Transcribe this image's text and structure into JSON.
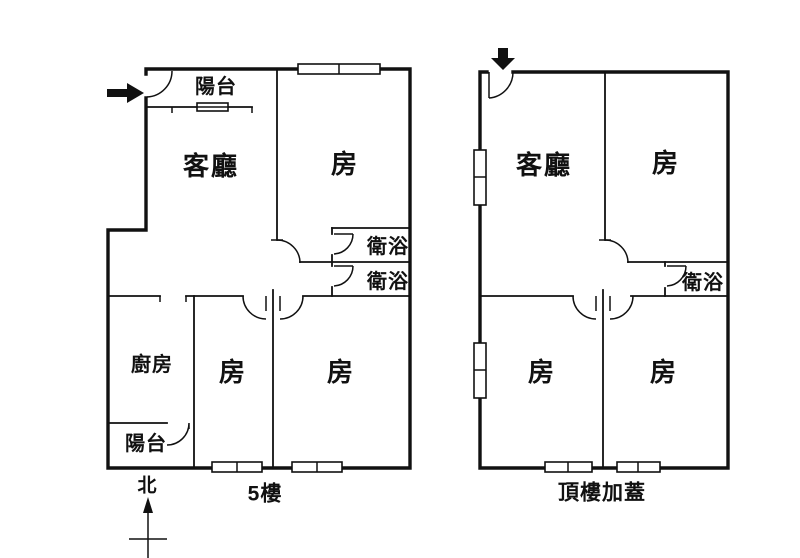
{
  "colors": {
    "background": "#ffffff",
    "line": "#111111",
    "text": "#111111"
  },
  "plans": [
    {
      "name": "floor-5",
      "caption": "5樓",
      "entry_icon": "arrow-right-icon",
      "compass": {
        "label": "北",
        "icon": "north-arrow-icon"
      },
      "rooms": [
        {
          "label": "陽台"
        },
        {
          "label": "客廳"
        },
        {
          "label": "房"
        },
        {
          "label": "衛浴"
        },
        {
          "label": "衛浴"
        },
        {
          "label": "廚房"
        },
        {
          "label": "房"
        },
        {
          "label": "房"
        },
        {
          "label": "陽台"
        }
      ]
    },
    {
      "name": "rooftop-addition",
      "caption": "頂樓加蓋",
      "entry_icon": "arrow-down-icon",
      "rooms": [
        {
          "label": "客廳"
        },
        {
          "label": "房"
        },
        {
          "label": "衛浴"
        },
        {
          "label": "房"
        },
        {
          "label": "房"
        }
      ]
    }
  ]
}
